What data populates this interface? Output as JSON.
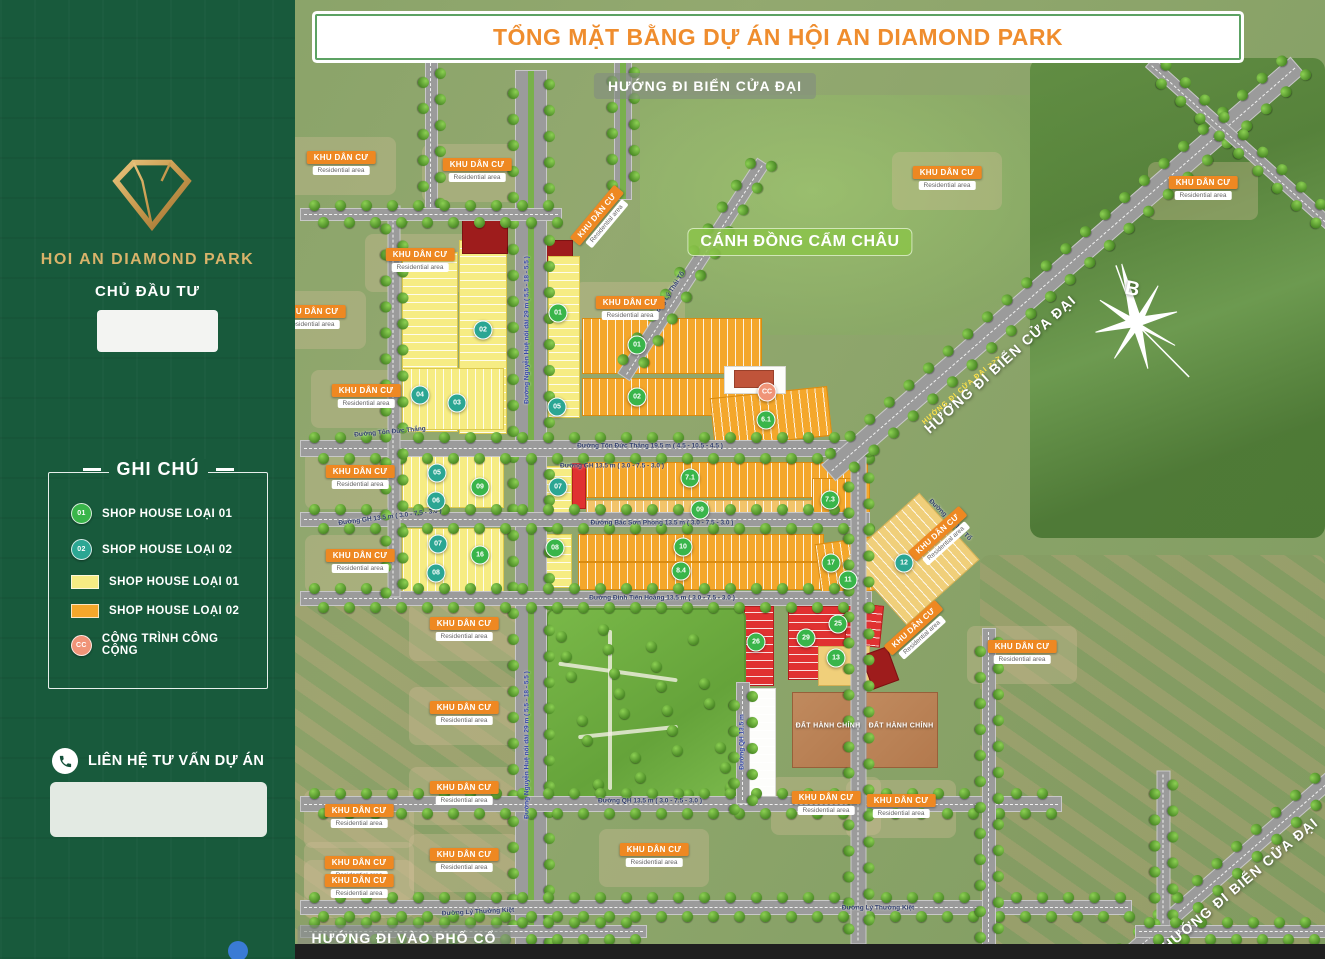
{
  "title_bar": {
    "text": "TỔNG MẶT BẰNG DỰ ÁN HỘI AN DIAMOND PARK"
  },
  "colors": {
    "sidebar_green": "#185a3c",
    "title_orange": "#ef8d2e",
    "gold": "#d9b36a",
    "badge_type1_green": "#39b54a",
    "badge_type2_teal": "#2ba693",
    "badge_public_salmon": "#f09478",
    "lot_yellow": "#f6ec83",
    "lot_orange": "#f4a72b",
    "lot_red": "#e03131",
    "area_label_orange": "#ee8822",
    "field_pill_green": "#8bc34a"
  },
  "sidebar": {
    "logo_text": "HOI AN DIAMOND PARK",
    "investor_heading": "CHỦ ĐẦU TƯ",
    "legend": {
      "heading": "GHI CHÚ",
      "items": [
        {
          "swatch": "circle",
          "color": "#39b54a",
          "badge": "01",
          "label": "SHOP HOUSE LOẠI 01"
        },
        {
          "swatch": "circle",
          "color": "#2ba693",
          "badge": "02",
          "label": "SHOP HOUSE LOẠI 02"
        },
        {
          "swatch": "rect",
          "color": "#f6ec83",
          "badge": "",
          "label": "SHOP HOUSE LOẠI 01"
        },
        {
          "swatch": "rect",
          "color": "#f4a72b",
          "badge": "",
          "label": "SHOP HOUSE LOẠI 02"
        },
        {
          "swatch": "circle",
          "color": "#f09478",
          "badge": "CC",
          "label": "CÔNG TRÌNH CÔNG CỘNG"
        }
      ]
    },
    "contact_heading": "LIÊN HỆ TƯ VẤN DỰ ÁN"
  },
  "map": {
    "compass_letter": "B",
    "area_label_text": "KHU DÂN CƯ",
    "area_label_sub": "Residential area",
    "area_labels": [
      {
        "x": 341,
        "y": 163,
        "rot": 0
      },
      {
        "x": 477,
        "y": 170,
        "rot": 0
      },
      {
        "x": 601,
        "y": 219,
        "rot": -50
      },
      {
        "x": 947,
        "y": 178,
        "rot": 0
      },
      {
        "x": 1203,
        "y": 188,
        "rot": 0
      },
      {
        "x": 420,
        "y": 260,
        "rot": 0
      },
      {
        "x": 630,
        "y": 308,
        "rot": 0
      },
      {
        "x": 311,
        "y": 317,
        "rot": 0
      },
      {
        "x": 366,
        "y": 396,
        "rot": 0
      },
      {
        "x": 360,
        "y": 477,
        "rot": 0
      },
      {
        "x": 360,
        "y": 561,
        "rot": 0
      },
      {
        "x": 941,
        "y": 538,
        "rot": -42
      },
      {
        "x": 917,
        "y": 632,
        "rot": -42
      },
      {
        "x": 1022,
        "y": 652,
        "rot": 0
      },
      {
        "x": 464,
        "y": 629,
        "rot": 0
      },
      {
        "x": 464,
        "y": 713,
        "rot": 0
      },
      {
        "x": 464,
        "y": 793,
        "rot": 0
      },
      {
        "x": 359,
        "y": 816,
        "rot": 0
      },
      {
        "x": 826,
        "y": 803,
        "rot": 0
      },
      {
        "x": 901,
        "y": 806,
        "rot": 0
      },
      {
        "x": 464,
        "y": 860,
        "rot": 0
      },
      {
        "x": 359,
        "y": 868,
        "rot": 0
      },
      {
        "x": 654,
        "y": 855,
        "rot": 0
      },
      {
        "x": 359,
        "y": 886,
        "rot": 0
      }
    ],
    "street_labels": [
      {
        "text": "Đường Nguyễn Huệ nối dài 29 m ( 5.5 - 18 - 5.5 )",
        "x": 527,
        "y": 330,
        "rot": -90,
        "tone": "blue"
      },
      {
        "text": "Đường Nguyễn Huệ nối dài 29 m ( 5.5 - 18 - 5.5 )",
        "x": 527,
        "y": 745,
        "rot": -90,
        "tone": "blue"
      },
      {
        "text": "Đường Tôn Đức Thắng",
        "x": 390,
        "y": 432,
        "rot": -5,
        "tone": "dark"
      },
      {
        "text": "Đường Tôn Đức Thắng 19.5 m ( 4.5 - 10.5 - 4.5 )",
        "x": 650,
        "y": 446,
        "rot": 0,
        "tone": "dark"
      },
      {
        "text": "Đường GH 13.5 m ( 3.0 - 7.5 - 3.0 )",
        "x": 612,
        "y": 466,
        "rot": 0,
        "tone": "dark"
      },
      {
        "text": "Đường GH 13.5 m ( 3.0 - 7.5 - 3.0 )",
        "x": 390,
        "y": 517,
        "rot": -7,
        "tone": "dark"
      },
      {
        "text": "Đường Bắc Sơn Phong 13.5 m ( 3.0 - 7.5 - 3.0 )",
        "x": 662,
        "y": 523,
        "rot": 0,
        "tone": "dark"
      },
      {
        "text": "Đường Đinh Tiên Hoàng 13.5 m ( 3.0 - 7.5 - 3.0 )",
        "x": 662,
        "y": 598,
        "rot": 0,
        "tone": "dark"
      },
      {
        "text": "Đường QH 13.5 m ( 3.0 - 7.5 - 3.0 )",
        "x": 650,
        "y": 801,
        "rot": 0,
        "tone": "dark"
      },
      {
        "text": "Đường QH 13.5 m",
        "x": 742,
        "y": 742,
        "rot": -90,
        "tone": "blue"
      },
      {
        "text": "Đường Lý Thường Kiệt",
        "x": 478,
        "y": 912,
        "rot": -3,
        "tone": "dark"
      },
      {
        "text": "Đường Lý Thường Kiệt",
        "x": 878,
        "y": 908,
        "rot": 0,
        "tone": "dark"
      },
      {
        "text": "Đường Lý Thái Tổ",
        "x": 668,
        "y": 296,
        "rot": -57,
        "tone": "dark"
      },
      {
        "text": "Đường Lý Thái Tổ",
        "x": 950,
        "y": 520,
        "rot": 44,
        "tone": "dark"
      }
    ],
    "direction_labels": [
      {
        "text": "HƯỚNG ĐI BIỂN CỬA ĐẠI",
        "x": 705,
        "y": 86,
        "rot": 0,
        "style": "pill"
      },
      {
        "text": "HƯỚNG ĐI VÀO PHỐ CỔ",
        "x": 404,
        "y": 938,
        "rot": 0,
        "style": "pill"
      },
      {
        "text": "CÁNH ĐỒNG CẨM CHÂU",
        "x": 800,
        "y": 242,
        "rot": 0,
        "style": "green"
      },
      {
        "text": "HƯỚNG ĐI BIỂN CỬA ĐẠI",
        "x": 1000,
        "y": 364,
        "rot": -42,
        "style": "plain"
      },
      {
        "text": "HƯỚNG ĐI BIỂN CỬA ĐẠI",
        "x": 1240,
        "y": 884,
        "rot": -40,
        "style": "plain"
      },
      {
        "text": "HƯỚNG ĐI CỬA ĐẠI >>>",
        "x": 962,
        "y": 390,
        "rot": -41,
        "style": "road"
      }
    ],
    "admin_labels": [
      {
        "text": "ĐẤT HÀNH CHÍNH",
        "x": 828,
        "y": 726
      },
      {
        "text": "ĐẤT HÀNH CHÍNH",
        "x": 901,
        "y": 726
      }
    ],
    "lot_badges": [
      {
        "n": "02",
        "type": "t",
        "x": 483,
        "y": 330
      },
      {
        "n": "01",
        "type": "g",
        "x": 558,
        "y": 313
      },
      {
        "n": "01",
        "type": "g",
        "x": 637,
        "y": 345
      },
      {
        "n": "05",
        "type": "t",
        "x": 557,
        "y": 407
      },
      {
        "n": "02",
        "type": "g",
        "x": 637,
        "y": 397
      },
      {
        "n": "CC",
        "type": "c",
        "x": 767,
        "y": 392
      },
      {
        "n": "6.1",
        "type": "g",
        "x": 766,
        "y": 420
      },
      {
        "n": "04",
        "type": "t",
        "x": 420,
        "y": 395
      },
      {
        "n": "03",
        "type": "t",
        "x": 457,
        "y": 403
      },
      {
        "n": "05",
        "type": "t",
        "x": 437,
        "y": 473
      },
      {
        "n": "09",
        "type": "g",
        "x": 480,
        "y": 487
      },
      {
        "n": "06",
        "type": "t",
        "x": 436,
        "y": 501
      },
      {
        "n": "07",
        "type": "t",
        "x": 438,
        "y": 544
      },
      {
        "n": "16",
        "type": "g",
        "x": 480,
        "y": 555
      },
      {
        "n": "08",
        "type": "t",
        "x": 436,
        "y": 573
      },
      {
        "n": "07",
        "type": "t",
        "x": 558,
        "y": 487
      },
      {
        "n": "7.1",
        "type": "g",
        "x": 690,
        "y": 478
      },
      {
        "n": "09",
        "type": "g",
        "x": 700,
        "y": 510
      },
      {
        "n": "7.3",
        "type": "g",
        "x": 830,
        "y": 500
      },
      {
        "n": "08",
        "type": "g",
        "x": 555,
        "y": 548
      },
      {
        "n": "10",
        "type": "g",
        "x": 683,
        "y": 547
      },
      {
        "n": "8.4",
        "type": "g",
        "x": 681,
        "y": 571
      },
      {
        "n": "17",
        "type": "g",
        "x": 831,
        "y": 563
      },
      {
        "n": "11",
        "type": "g",
        "x": 848,
        "y": 580
      },
      {
        "n": "12",
        "type": "t",
        "x": 904,
        "y": 563
      },
      {
        "n": "26",
        "type": "g",
        "x": 756,
        "y": 642
      },
      {
        "n": "29",
        "type": "g",
        "x": 806,
        "y": 638
      },
      {
        "n": "25",
        "type": "g",
        "x": 838,
        "y": 624
      },
      {
        "n": "13",
        "type": "g",
        "x": 836,
        "y": 658
      }
    ]
  }
}
